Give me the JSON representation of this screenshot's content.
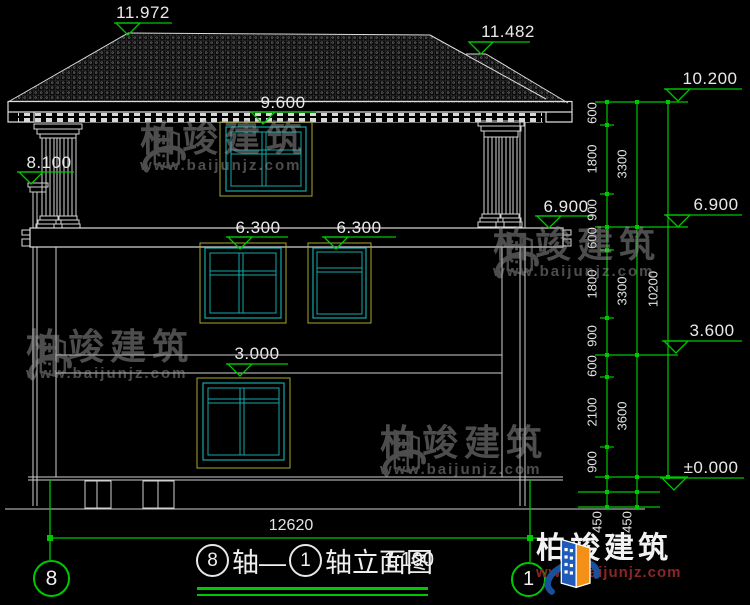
{
  "drawing": {
    "elevation_marks": {
      "ridge_main": "11.972",
      "ridge_secondary": "11.482",
      "attic_window_top": "9.600",
      "porch_beam": "8.100",
      "roof_top_chain": "10.200",
      "floor2_building": "6.900",
      "floor2_chain": "6.900",
      "window2a_top": "6.300",
      "window2b_top": "6.300",
      "level_chain_36": "3.600",
      "window1_top": "3.000",
      "ground_level": "±0.000"
    },
    "dim_chain": {
      "col1": [
        "600",
        "1800",
        "900",
        "600",
        "1800",
        "900",
        "600",
        "2100",
        "900"
      ],
      "col2": [
        "3300",
        "3300",
        "3600"
      ],
      "col3_total": "10200",
      "below_ground": [
        "450",
        "450"
      ]
    },
    "width_dim": "12620",
    "axis_left": "8",
    "axis_right": "1"
  },
  "title_block": {
    "axis_start_bubble": "8",
    "between": "轴—",
    "axis_end_bubble": "1",
    "suffix": "轴立面图",
    "scale": "1:100"
  },
  "watermark": {
    "brand": "柏竣建筑",
    "url": "www.baijunjz.com"
  },
  "logo": {
    "brand": "柏竣建筑",
    "url": "www.baijunjz.com"
  }
}
